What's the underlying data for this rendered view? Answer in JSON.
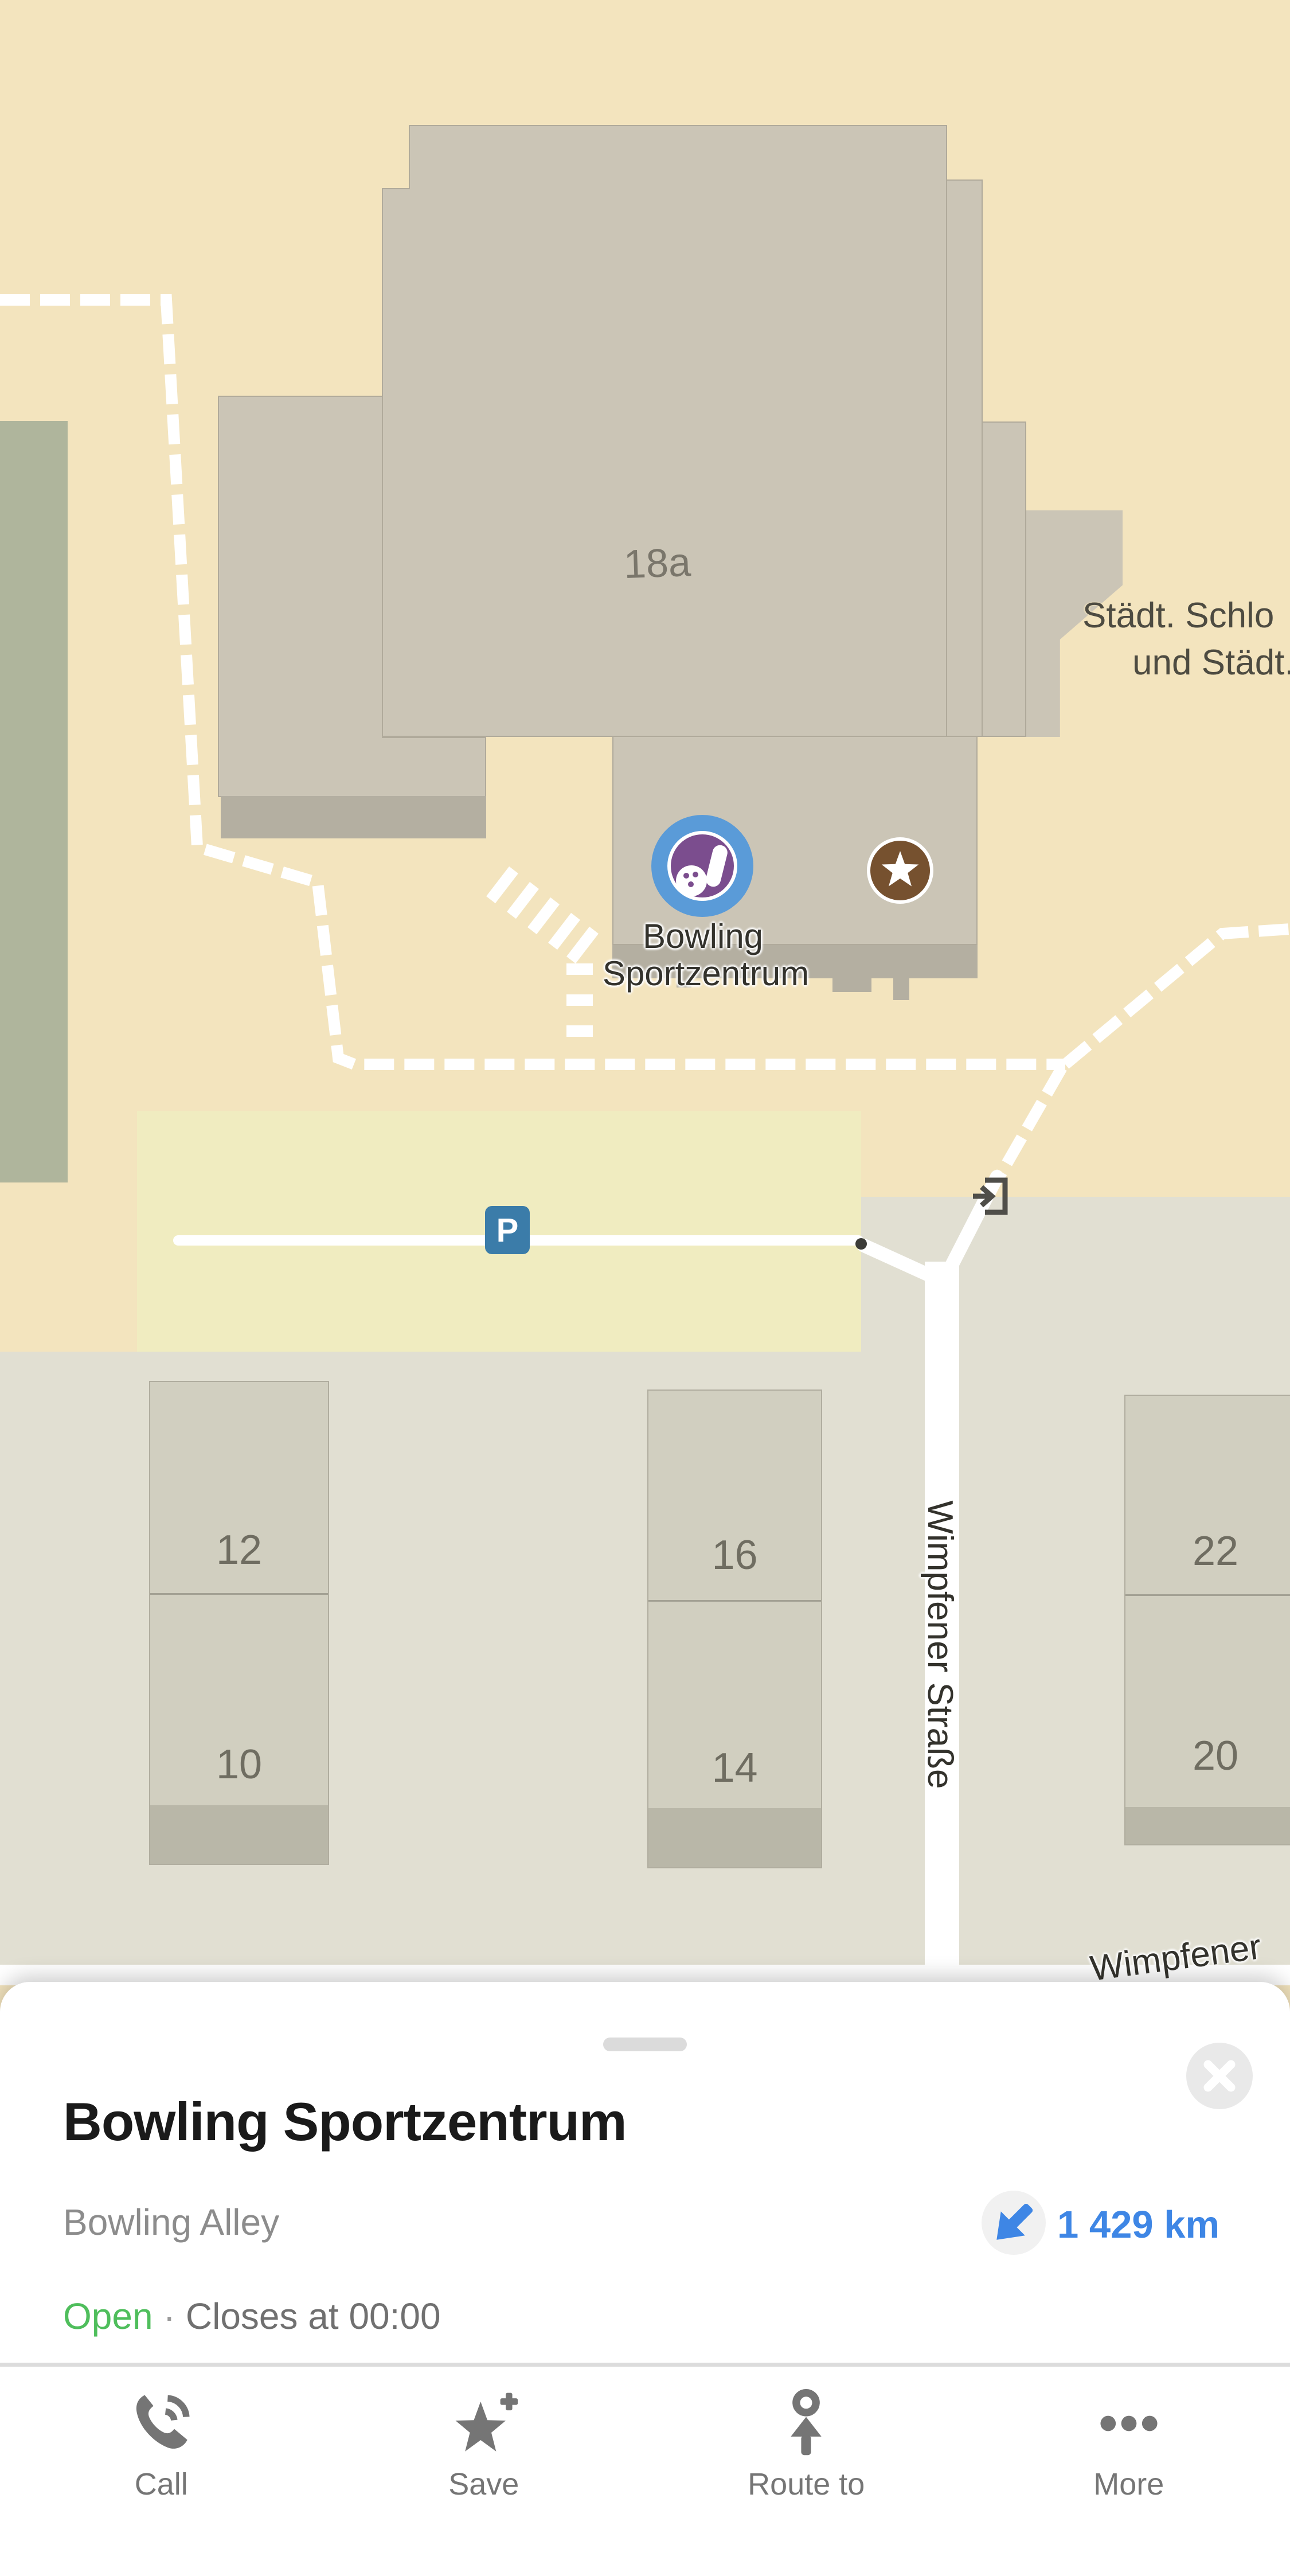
{
  "map": {
    "building_label": "18a",
    "poi": {
      "name_line1": "Bowling",
      "name_line2": "Sportzentrum"
    },
    "clipped_label_line1": "Städt. Schlo",
    "clipped_label_line2": "und Städt.",
    "street_vertical": "Wimpfener Straße",
    "street_horizontal": "Wimpfener",
    "parking_badge": "P",
    "house_numbers": {
      "b1_top": "12",
      "b1_bottom": "10",
      "b2_top": "16",
      "b2_bottom": "14",
      "b3_top": "22",
      "b3_bottom": "20"
    },
    "colors": {
      "background": "#F3E4BE",
      "building": "#CBC5B6",
      "parking": "#F0ECC0",
      "green": "#AFB59C",
      "lower_bg": "#E1DFD2",
      "poi_blue": "#5A9BD8",
      "poi_purple": "#7B4D8E",
      "star_brown": "#76512F",
      "parking_blue": "#3B7CA9"
    }
  },
  "sheet": {
    "title": "Bowling Sportzentrum",
    "category": "Bowling Alley",
    "distance": "1 429 km",
    "status": {
      "open": "Open",
      "separator": "·",
      "closes": "Closes at 00:00"
    },
    "actions": [
      {
        "id": "call",
        "label": "Call"
      },
      {
        "id": "save",
        "label": "Save"
      },
      {
        "id": "route",
        "label": "Route to"
      },
      {
        "id": "more",
        "label": "More"
      }
    ],
    "colors": {
      "distance_blue": "#3E86E5",
      "open_green": "#4FBE5C"
    }
  }
}
